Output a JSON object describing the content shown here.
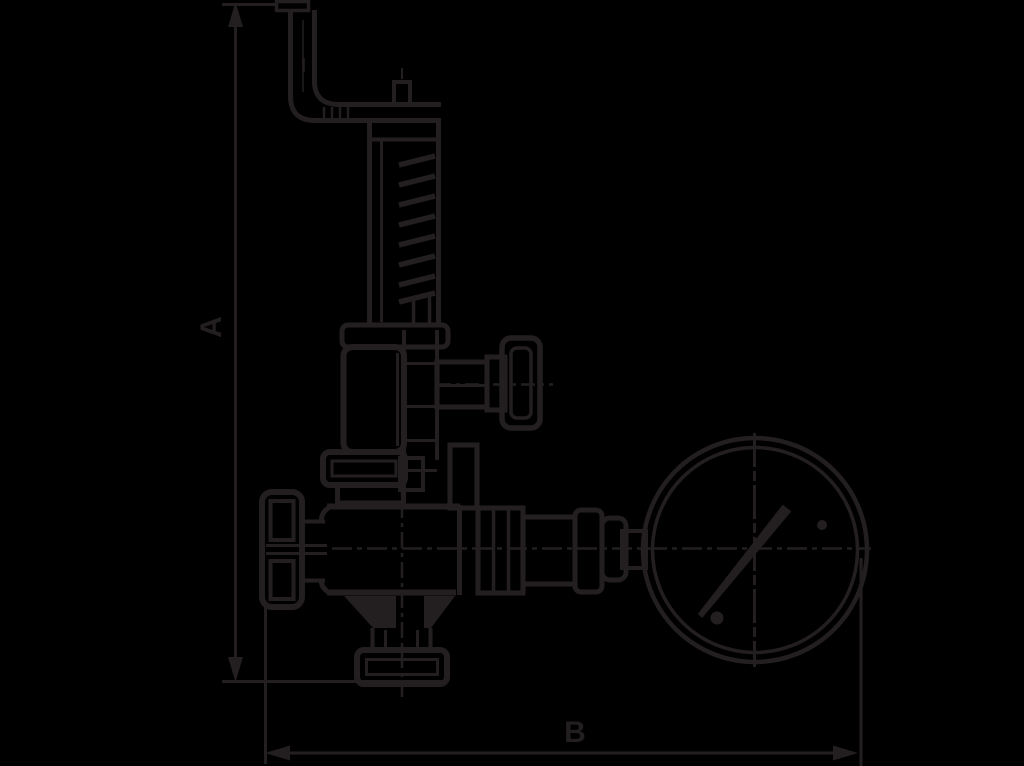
{
  "page": {
    "background": "#000000"
  },
  "drawing": {
    "description": "Technical outline drawing of a spring-loaded valve with handwheel, bent vent pipe, tee-handle side tap and a round pressure gauge, annotated with overall dimension lines",
    "line_color": "#231f20",
    "dimensions": {
      "height_label": "A",
      "width_label": "B"
    }
  }
}
